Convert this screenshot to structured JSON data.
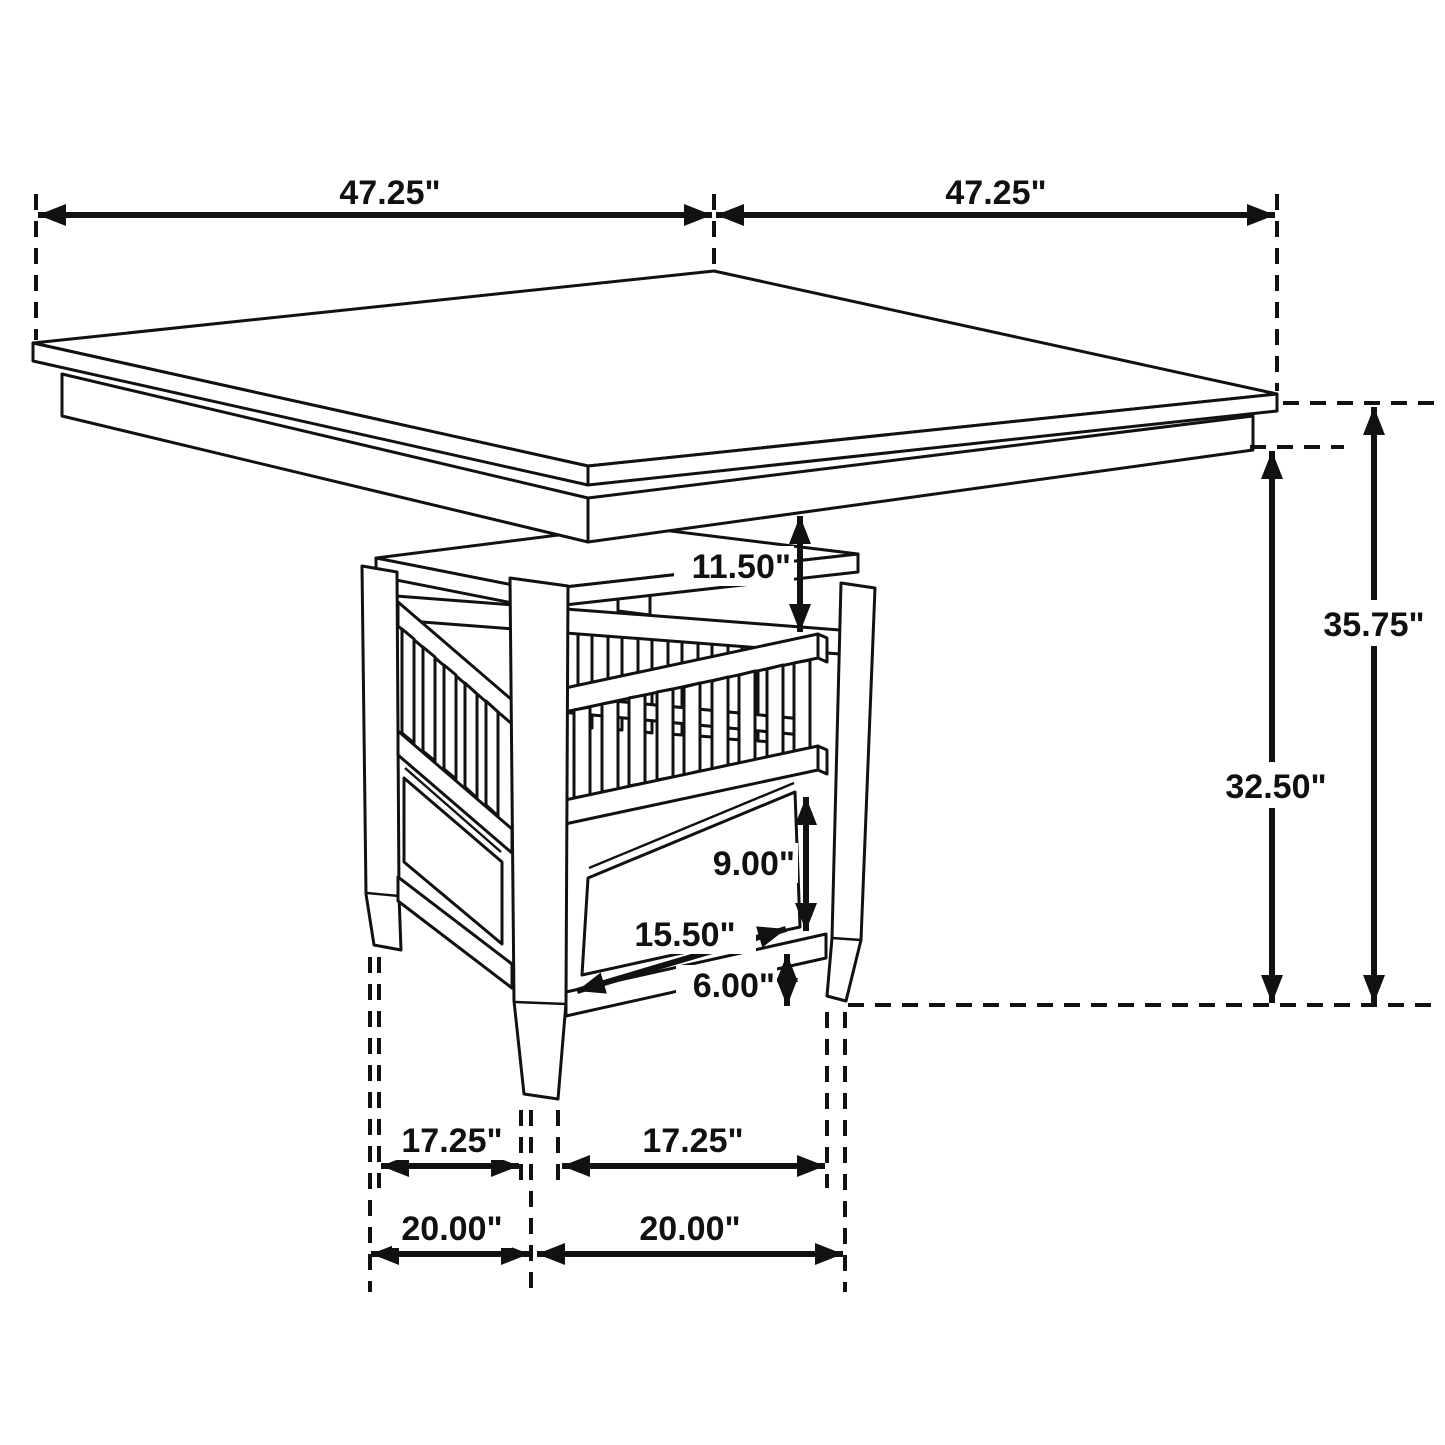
{
  "diagram": {
    "type": "furniture-dimension-drawing",
    "subject": "square counter-height dining table with slatted storage pedestal and drawer",
    "colors": {
      "line": "#111111",
      "background": "#ffffff"
    },
    "dimensions": {
      "table_width_left": "47.25\"",
      "table_width_right": "47.25\"",
      "table_height": "35.75\"",
      "base_height": "32.50\"",
      "shelf_clearance": "11.50\"",
      "drawer_height": "9.00\"",
      "drawer_width": "15.50\"",
      "floor_clearance": "6.00\"",
      "foot_span_inner_left": "17.25\"",
      "foot_span_inner_right": "17.25\"",
      "foot_span_outer_left": "20.00\"",
      "foot_span_outer_right": "20.00\""
    }
  }
}
